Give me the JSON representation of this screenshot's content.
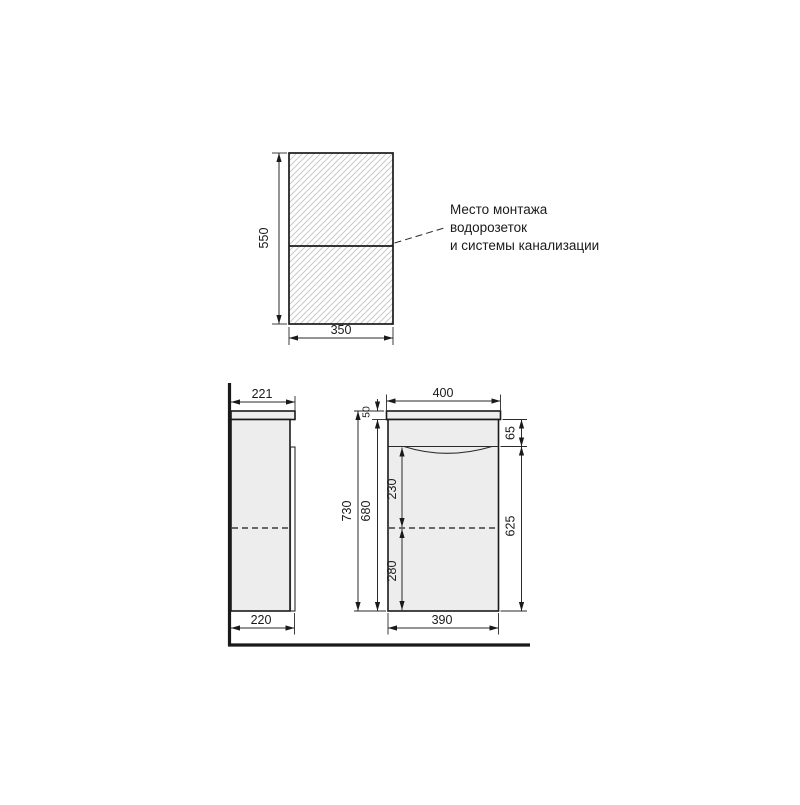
{
  "drawing": {
    "kind": "vanity-installation-technical-drawing",
    "units": "mm"
  },
  "colors": {
    "line": "#1a1a1a",
    "panel_fill": "#ededed",
    "hatch": "#c9c9c9",
    "background": "#ffffff"
  },
  "annotation": {
    "line1": "Место монтажа",
    "line2": "водорозеток",
    "line3": "и системы канализации"
  },
  "top_view": {
    "height": "550",
    "width": "350"
  },
  "side_view": {
    "top_depth": "221",
    "bottom_depth": "220"
  },
  "front_view": {
    "overall_width": "400",
    "overall_height": "730",
    "body_height": "680",
    "countertop_thickness": "50",
    "top_panel_height": "65",
    "upper_section": "230",
    "lower_section": "280",
    "front_height": "625",
    "body_width": "390"
  }
}
